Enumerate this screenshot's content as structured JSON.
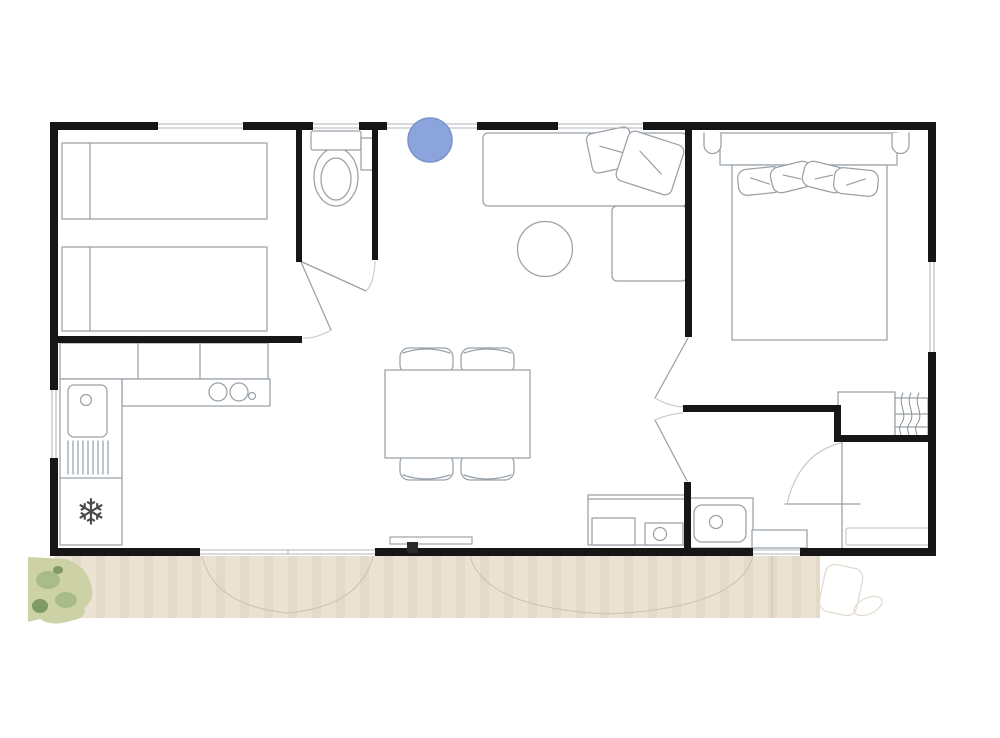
{
  "title": "",
  "colors": {
    "background": "#ffffff",
    "wall": "#161616",
    "furniture_line": "#99a1a7",
    "light_line": "#c6ccd1",
    "deck": "#ebe2d3",
    "deck_stripe": "#ddd1bd",
    "deck_arc": "#cfc0ab",
    "bush": "#ccd2a6",
    "bush_mid": "#a9bc88",
    "bush_dark": "#7f9a63",
    "marker_fill": "#8ba5dc",
    "marker_stroke": "#7b93cc",
    "snowflake": "#4a4a4a"
  },
  "icons": {
    "snowflake": "❄"
  },
  "marker": {
    "name": "entrance-marker",
    "shape": "circle",
    "color": "#8ba5dc"
  },
  "plan": {
    "type": "floorplan",
    "rooms": [
      {
        "name": "twin-bedroom",
        "furniture": [
          "twin-bed",
          "twin-bed"
        ]
      },
      {
        "name": "wc",
        "furniture": [
          "toilet",
          "shelf"
        ]
      },
      {
        "name": "kitchen",
        "furniture": [
          "wall-cabinets",
          "counter",
          "cooktop",
          "sink",
          "drainboard",
          "fridge"
        ]
      },
      {
        "name": "dining-area",
        "furniture": [
          "dining-table",
          "chair",
          "chair",
          "chair",
          "chair"
        ]
      },
      {
        "name": "living-area",
        "furniture": [
          "corner-sofa",
          "cushion",
          "cushion",
          "round-coffee-table"
        ]
      },
      {
        "name": "double-bedroom",
        "furniture": [
          "headboard",
          "double-bed",
          "pillows",
          "nightstand",
          "nightstand",
          "wardrobe"
        ]
      },
      {
        "name": "bathroom",
        "furniture": [
          "washbasin-vanity",
          "low-cabinet",
          "shower",
          "utility-unit"
        ]
      },
      {
        "name": "terrace",
        "furniture": [
          "sliding-door",
          "planting"
        ]
      }
    ]
  }
}
